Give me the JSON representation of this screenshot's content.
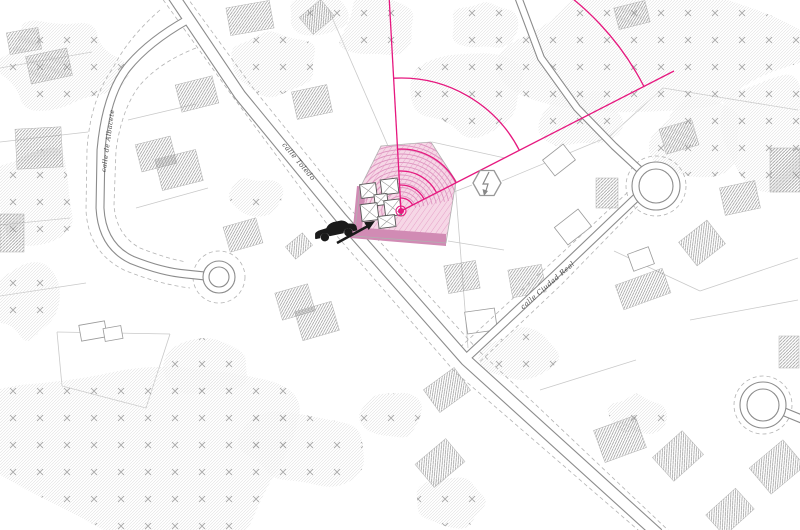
{
  "streets": {
    "albacete": "calle de Albacete",
    "toledo": "calle Toledo",
    "ciudad_real": "calle Ciudad Real"
  },
  "colors": {
    "accent_magenta": "#e6187f",
    "site_fill": "#f6d7e6",
    "site_hatch": "#e59bc5",
    "site_dark_band": "#d18bb4",
    "fan_arc": "#dd93bf",
    "road_line": "#8c8c8c",
    "parcel_line": "#c9c9c9",
    "building_hatch": "#8f8f8f",
    "vegetation": "#dedede",
    "tree_mark": "#a0a0a0",
    "symbol_gray": "#999999",
    "ink": "#1a1a1a"
  },
  "icons": {
    "transformer": "hexagon-lightning-icon",
    "car": "car-icon",
    "arrow": "arrow-icon",
    "site_marker": "site-marker-dot"
  },
  "map": {
    "labels": [
      {
        "key": "albacete",
        "x": 110,
        "y": 141,
        "rot": -82,
        "size": 6.5
      },
      {
        "key": "toledo",
        "x": 297,
        "y": 163,
        "rot": 50,
        "size": 7
      },
      {
        "key": "ciudad_real",
        "x": 549,
        "y": 287,
        "rot": -41,
        "size": 7
      }
    ],
    "roads": [
      {
        "d": "M172,-6 L240,95 L341,218 L466,360 L658,534",
        "w": 12.5
      },
      {
        "d": "M462,362 L555,275 L640,194",
        "w": 9
      },
      {
        "d": "M517,-6 L541,58 L577,108 L614,146 L640,170",
        "w": 8
      },
      {
        "d": "M187,20 Q148,42 127,68 Q106,95 101,150 L100,208 Q102,246 132,260 Q162,272 186,274 L205,276",
        "w": 9
      },
      {
        "d": "M782,411 L804,420",
        "w": 9
      }
    ],
    "dashed_lines": [
      "M159,-6 L228,90 L330,228 L455,372 L645,536",
      "M186,-4 L253,88 L353,212 L478,350 L670,532",
      "M455,352 L548,266 L628,192",
      "M470,371 L562,284 L638,206",
      "M160,10 Q128,38 113,68 Q90,100 87,150 L86,210 Q88,252 124,270 Q158,284 190,288",
      "M196,48 Q160,62 140,85 Q122,108 116,150 L114,205 Q116,235 140,248 Q165,258 186,262"
    ],
    "roundabouts": [
      {
        "cx": 656,
        "cy": 186,
        "r1": 24,
        "r2": 17,
        "rd": 30
      },
      {
        "cx": 219,
        "cy": 277,
        "r1": 16,
        "r2": 10,
        "rd": 26
      },
      {
        "cx": 763,
        "cy": 405,
        "r1": 23,
        "r2": 16,
        "rd": 29
      }
    ],
    "parcel_lines": [
      [
        0,
        68,
        92,
        52
      ],
      [
        0,
        142,
        88,
        132
      ],
      [
        0,
        225,
        70,
        218
      ],
      [
        0,
        296,
        86,
        283
      ],
      [
        128,
        120,
        196,
        104
      ],
      [
        136,
        208,
        208,
        188
      ],
      [
        328,
        8,
        388,
        146
      ],
      [
        432,
        142,
        505,
        158
      ],
      [
        428,
        202,
        472,
        185
      ],
      [
        502,
        181,
        610,
        136
      ],
      [
        610,
        136,
        663,
        88
      ],
      [
        663,
        88,
        798,
        110
      ],
      [
        455,
        181,
        468,
        348
      ],
      [
        448,
        241,
        504,
        250
      ],
      [
        57,
        332,
        170,
        334
      ],
      [
        170,
        334,
        146,
        408
      ],
      [
        146,
        408,
        62,
        386
      ],
      [
        62,
        386,
        57,
        332
      ],
      [
        614,
        251,
        700,
        291
      ],
      [
        700,
        291,
        798,
        258
      ],
      [
        690,
        320,
        798,
        300
      ],
      [
        540,
        390,
        636,
        360
      ]
    ],
    "vegetation_blobs": [
      [
        60,
        66,
        62,
        46,
        1
      ],
      [
        34,
        200,
        46,
        52,
        2
      ],
      [
        26,
        300,
        34,
        38,
        3
      ],
      [
        140,
        445,
        165,
        100,
        4
      ],
      [
        268,
        62,
        46,
        32,
        5
      ],
      [
        318,
        14,
        30,
        20,
        6
      ],
      [
        378,
        28,
        40,
        32,
        7
      ],
      [
        468,
        93,
        55,
        42,
        8
      ],
      [
        486,
        25,
        33,
        27,
        9
      ],
      [
        655,
        52,
        148,
        68,
        10
      ],
      [
        770,
        130,
        44,
        58,
        11
      ],
      [
        698,
        138,
        46,
        38,
        12
      ],
      [
        518,
        358,
        36,
        28,
        13
      ],
      [
        636,
        416,
        28,
        20,
        14
      ],
      [
        392,
        416,
        30,
        24,
        15
      ],
      [
        448,
        502,
        34,
        26,
        16
      ],
      [
        258,
        198,
        26,
        20,
        17
      ],
      [
        300,
        448,
        60,
        40,
        18
      ],
      [
        210,
        368,
        40,
        28,
        19
      ],
      [
        580,
        118,
        40,
        30,
        20
      ]
    ],
    "buildings": [
      [
        8,
        30,
        32,
        22,
        -10
      ],
      [
        28,
        52,
        42,
        28,
        -12
      ],
      [
        16,
        128,
        46,
        40,
        -3
      ],
      [
        0,
        214,
        24,
        38,
        0
      ],
      [
        138,
        140,
        36,
        28,
        -14
      ],
      [
        158,
        154,
        42,
        32,
        -14
      ],
      [
        178,
        80,
        38,
        28,
        -14
      ],
      [
        228,
        4,
        44,
        28,
        -10
      ],
      [
        294,
        88,
        36,
        28,
        -12
      ],
      [
        303,
        6,
        28,
        22,
        -40
      ],
      [
        226,
        222,
        34,
        26,
        -16
      ],
      [
        278,
        288,
        34,
        28,
        -16
      ],
      [
        298,
        306,
        38,
        30,
        -16
      ],
      [
        446,
        263,
        32,
        28,
        -10
      ],
      [
        510,
        267,
        34,
        28,
        -10
      ],
      [
        428,
        376,
        38,
        28,
        -36
      ],
      [
        420,
        448,
        40,
        30,
        -40
      ],
      [
        598,
        422,
        44,
        34,
        -20
      ],
      [
        658,
        440,
        40,
        32,
        -42
      ],
      [
        710,
        498,
        40,
        28,
        -42
      ],
      [
        755,
        450,
        44,
        34,
        -40
      ],
      [
        596,
        178,
        22,
        30,
        0
      ],
      [
        662,
        124,
        34,
        26,
        -16
      ],
      [
        722,
        184,
        36,
        28,
        -12
      ],
      [
        684,
        228,
        36,
        30,
        -38
      ],
      [
        618,
        276,
        50,
        26,
        -20
      ],
      [
        770,
        148,
        30,
        44,
        0
      ],
      [
        779,
        336,
        20,
        32,
        0
      ],
      [
        616,
        4,
        32,
        22,
        -14
      ],
      [
        288,
        238,
        22,
        16,
        -40
      ]
    ],
    "white_buildings": [
      [
        466,
        310,
        30,
        22,
        -8
      ],
      [
        546,
        150,
        26,
        20,
        -38
      ],
      [
        558,
        216,
        30,
        22,
        -38
      ],
      [
        630,
        250,
        22,
        18,
        -20
      ],
      [
        80,
        323,
        26,
        16,
        -10
      ],
      [
        104,
        327,
        18,
        13,
        -10
      ]
    ],
    "site": {
      "polygon": [
        [
          381,
          146
        ],
        [
          431,
          142
        ],
        [
          456,
          181
        ],
        [
          446,
          243
        ],
        [
          354,
          236
        ],
        [
          360,
          188
        ]
      ],
      "dark_bands": [
        [
          [
            357,
            186
          ],
          [
            366,
            187
          ],
          [
            362,
            229
          ],
          [
            353,
            228
          ]
        ],
        [
          [
            352,
            227
          ],
          [
            446,
            234
          ],
          [
            446,
            246
          ],
          [
            350,
            238
          ]
        ]
      ],
      "cluster": {
        "x": 382,
        "y": 203,
        "rot": -7,
        "rects": [
          [
            -20,
            -21,
            16,
            14
          ],
          [
            1,
            -23,
            17,
            15
          ],
          [
            -7,
            -9,
            13,
            11
          ],
          [
            -22,
            -1,
            17,
            17
          ],
          [
            2,
            -2,
            16,
            16
          ],
          [
            -6,
            13,
            17,
            12
          ]
        ]
      }
    },
    "sector": {
      "cx": 401,
      "cy": 211,
      "rays": [
        [
          389,
          -5
        ],
        [
          674,
          71
        ]
      ],
      "arc_radii": [
        13,
        26,
        40,
        62,
        133,
        273
      ],
      "fan": {
        "r0": 15,
        "r1": 78,
        "step": 4.2,
        "a1": -195,
        "a2": -12
      }
    },
    "transformer": {
      "cx": 487,
      "cy": 183
    },
    "car": {
      "x": 310,
      "y": 224,
      "rot": -12
    },
    "arrow": {
      "x1": 337,
      "y1": 243,
      "x2": 368,
      "y2": 226,
      "head": [
        [
          375,
          221
        ],
        [
          368.7,
          230
        ],
        [
          364.1,
          222.2
        ]
      ]
    }
  }
}
